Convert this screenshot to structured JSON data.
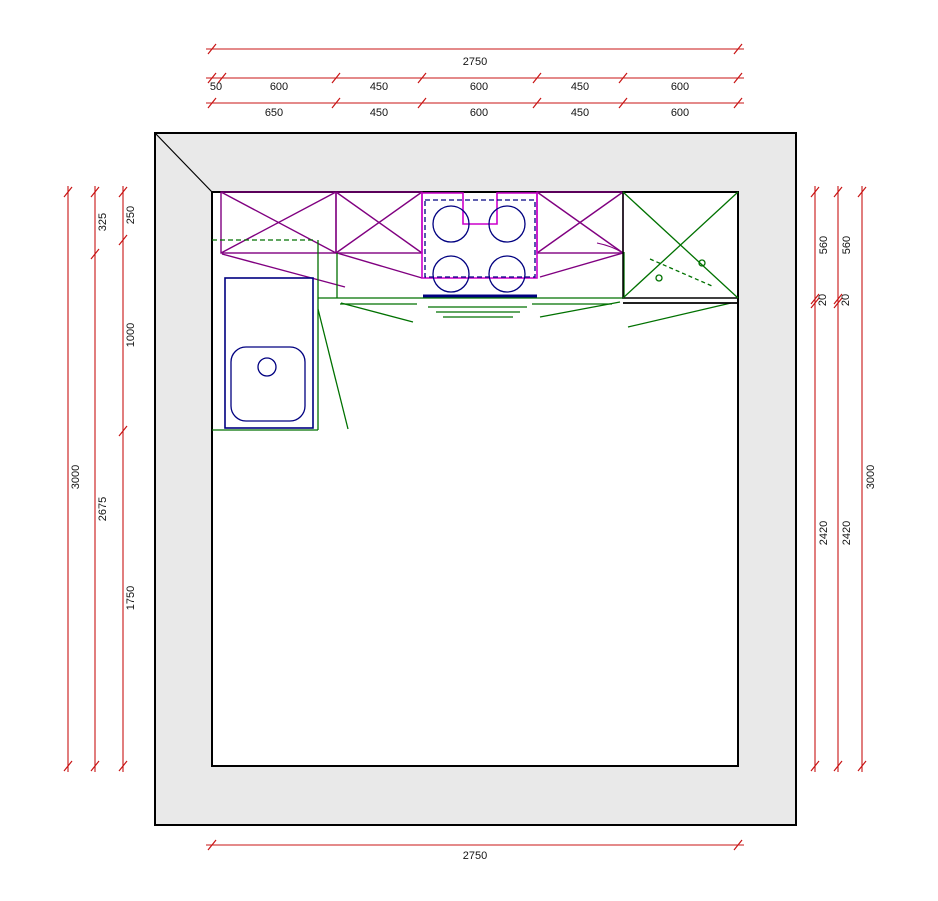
{
  "dimensions": {
    "top": {
      "overall": "2750",
      "segments_row2": [
        "50",
        "600",
        "450",
        "600",
        "450",
        "600"
      ],
      "segments_row3": [
        "650",
        "450",
        "600",
        "450",
        "600"
      ]
    },
    "bottom": {
      "overall": "2750"
    },
    "left": {
      "overall": "3000",
      "segments_row2": [
        "325",
        "2675"
      ],
      "segments_row3": [
        "250",
        "1000",
        "1750"
      ]
    },
    "right": {
      "segments_line1": [
        "560",
        "20",
        "2420"
      ],
      "segments_line2": [
        "560",
        "20",
        "2420"
      ],
      "overall": "3000"
    }
  },
  "colors": {
    "dimension": "#c81414",
    "text": "#141414",
    "wall_fill": "#e9e9e9",
    "outline": "#000000",
    "wall_cabinet": "#800080",
    "hob": "#cc00cc",
    "worktop": "#007100",
    "fixture": "#000080"
  }
}
